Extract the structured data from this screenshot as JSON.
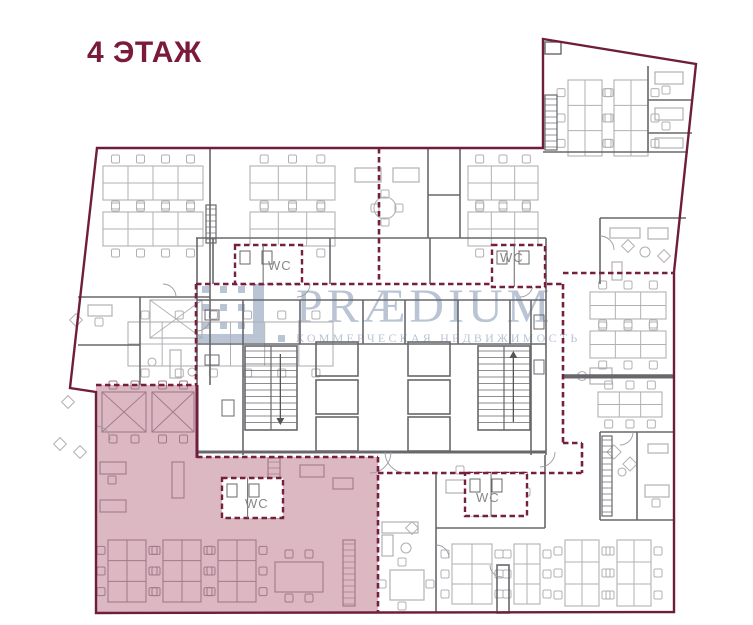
{
  "plan": {
    "floor_label": "4 ЭТАЖ",
    "wc_label": "WC"
  },
  "watermark": {
    "brand": "PRÆDIUM",
    "subtitle": "КОММЕРЧЕСКАЯ НЕДВИЖИМОСТЬ"
  },
  "colors": {
    "background": "#ffffff",
    "title": "#7b1b3c",
    "boundary": "#6e1e3c",
    "dashed": "#76203f",
    "highlight_fill": "#dbb8c2",
    "highlight_furniture": "#a3798b",
    "wall": "#68686c",
    "furniture": "#b2b0b4",
    "watermark": "#b6c1d2",
    "wc_text": "#87878a"
  }
}
